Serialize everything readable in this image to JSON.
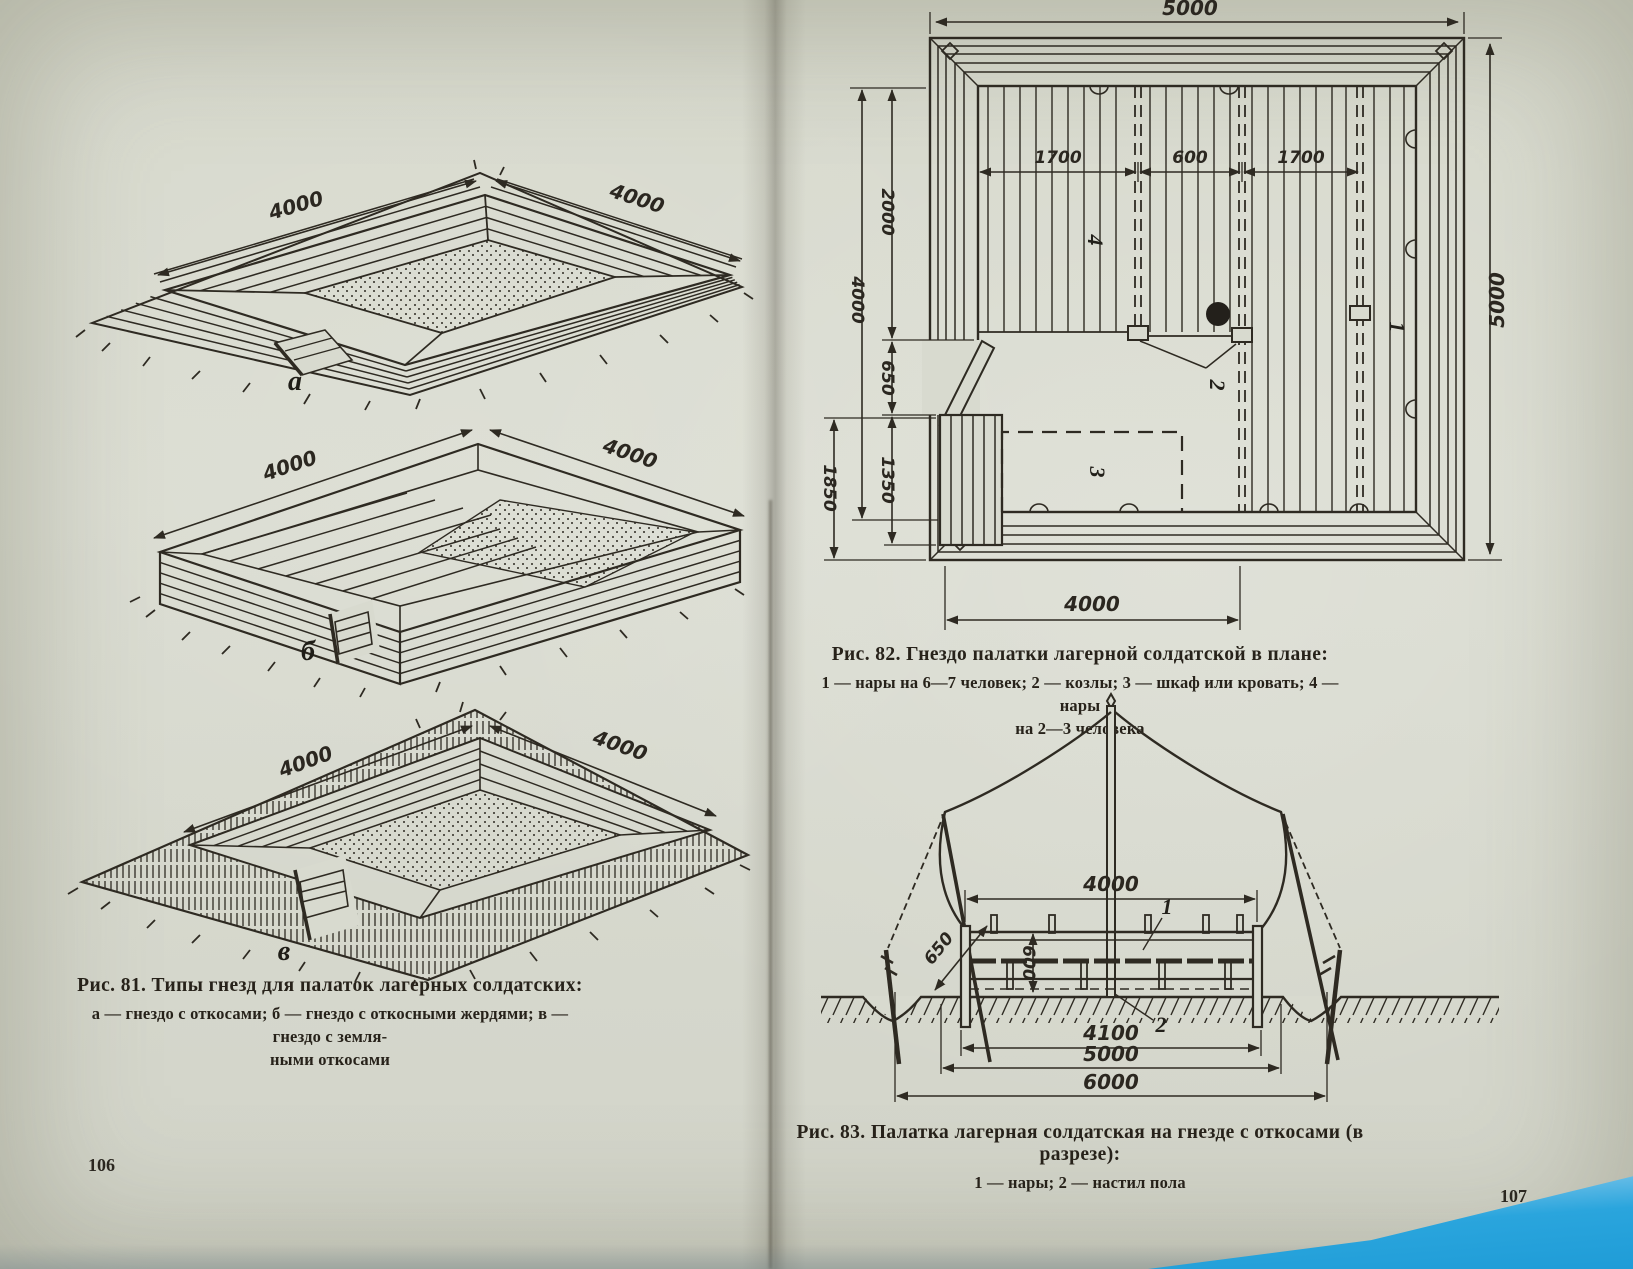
{
  "colors": {
    "paper": "#d8dacf",
    "ink": "#2e2a22",
    "backdrop_blue": "#2aa5dd"
  },
  "left_page": {
    "page_number": "106",
    "figure_81": {
      "caption_title": "Рис. 81. Типы гнезд для палаток лагерных солдатских:",
      "caption_legend_line1": "а — гнездо с откосами; б — гнездо с откосными жердями; в — гнездо с земля-",
      "caption_legend_line2": "ными откосами",
      "drawing_a": {
        "label": "а",
        "dim_left": "4000",
        "dim_right": "4000"
      },
      "drawing_b": {
        "label": "б",
        "dim_left": "4000",
        "dim_right": "4000"
      },
      "drawing_v": {
        "label": "в",
        "dim_left": "4000",
        "dim_right": "4000"
      }
    }
  },
  "right_page": {
    "page_number": "107",
    "figure_82": {
      "caption_title": "Рис. 82. Гнездо палатки лагерной солдатской в плане:",
      "caption_legend_line1": "1 — нары на 6—7 человек; 2 — козлы; 3 — шкаф или кровать; 4 — нары",
      "caption_legend_line2": "на 2—3 человека",
      "plan": {
        "dim_top": "5000",
        "dim_right": "5000",
        "dim_bottom": "4000",
        "dim_inner_left": "1700",
        "dim_inner_center": "600",
        "dim_inner_right": "1700",
        "dim_left_outer": "4000",
        "dim_left_upper": "2000",
        "dim_left_gap": "650",
        "dim_left_porch": "1350",
        "dim_left_total": "1850",
        "label_1": "1",
        "label_2": "2",
        "label_3": "3",
        "label_4": "4"
      }
    },
    "figure_83": {
      "caption_title": "Рис. 83. Палатка лагерная солдатская на гнезде с откосами (в разрезе):",
      "caption_legend": "1 — нары; 2 — настил пола",
      "section": {
        "dim_top": "4000",
        "dim_slope": "650",
        "dim_height": "600",
        "dim_inner": "4100",
        "dim_mid": "5000",
        "dim_outer": "6000",
        "label_1": "1",
        "label_2": "2"
      }
    }
  }
}
